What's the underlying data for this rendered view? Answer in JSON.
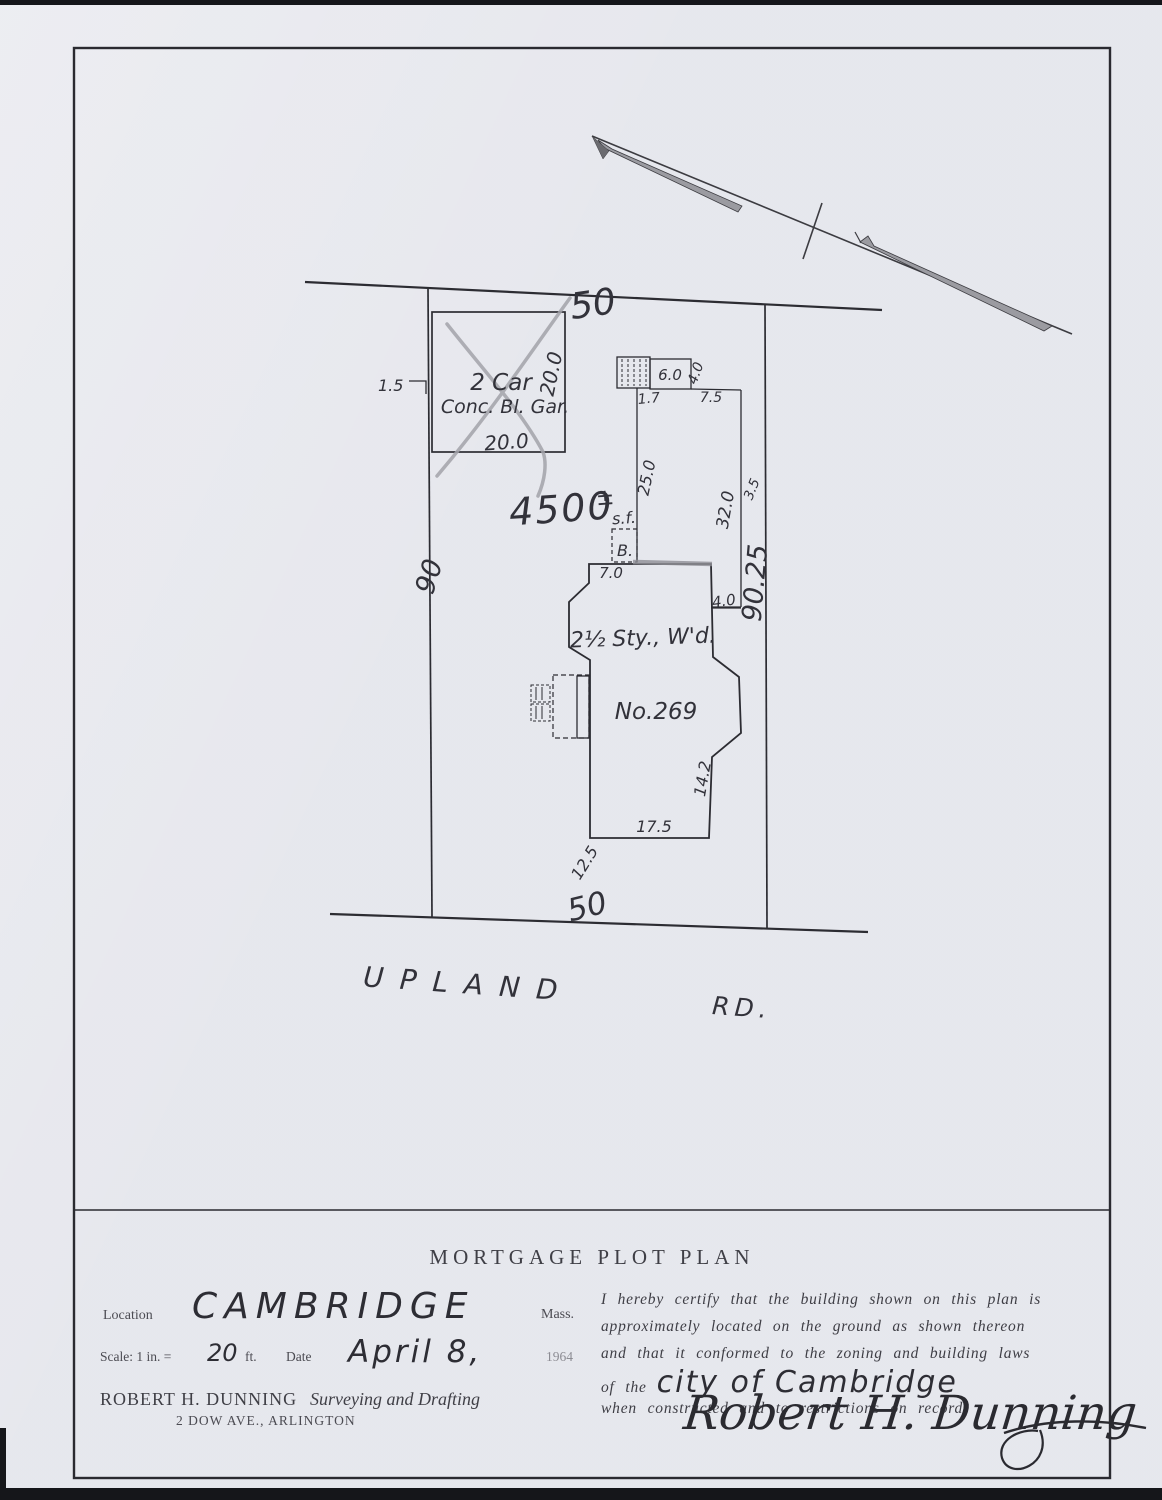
{
  "colors": {
    "paper": "#ecedf2",
    "ink": "#2f2f34",
    "typed_text": "#4b4b52",
    "pencil": "#a3a3aa"
  },
  "plan": {
    "street": {
      "name": "UPLAND",
      "suffix": "RD."
    },
    "lot": {
      "frontage_top": "50",
      "frontage_bottom": "50",
      "side_left": "90",
      "side_right": "90.25",
      "area_number": "4500",
      "area_pm": "±",
      "area_unit": "s.f."
    },
    "garage": {
      "label_line1": "2 Car",
      "label_line2": "Conc. Bl. Gar.",
      "dim_side": "20.0",
      "dim_front": "20.0",
      "offset": "1.5"
    },
    "rear_structure": {
      "width": "6.0",
      "offset_left": "1.7",
      "offset_right": "7.5",
      "depth": "4.0"
    },
    "house": {
      "bay": "B.",
      "type": "2½ Sty., W'd.",
      "number": "No.269",
      "dim_front_left": "7.0",
      "dim_side_step": "4.0",
      "dim_rear_gap": "25.0",
      "dim_side_gap": "32.0",
      "dim_corner_gap": "3.5",
      "dim_right": "14.2",
      "dim_bottom": "17.5",
      "dim_setback": "12.5"
    }
  },
  "title_block": {
    "heading": "MORTGAGE PLOT PLAN",
    "location_label": "Location",
    "location_value": "CAMBRIDGE",
    "state": "Mass.",
    "scale_label": "Scale: 1 in. =",
    "scale_value": "20",
    "scale_unit": "ft.",
    "date_label": "Date",
    "date_value": "April 8,",
    "year": "1964",
    "surveyor_name": "ROBERT H. DUNNING",
    "surveyor_role": "Surveying and Drafting",
    "surveyor_address": "2 DOW AVE., ARLINGTON",
    "certification": {
      "line1": "I hereby certify that the building shown on this plan is",
      "line2": "approximately located on the ground as shown thereon",
      "line3": "and that it conformed to the zoning and building laws",
      "line4_prefix": "of the",
      "line4_city": "city of Cambridge",
      "line5": "when constructed and to restrictions on record."
    },
    "signature": "Robert H. Dunning"
  }
}
